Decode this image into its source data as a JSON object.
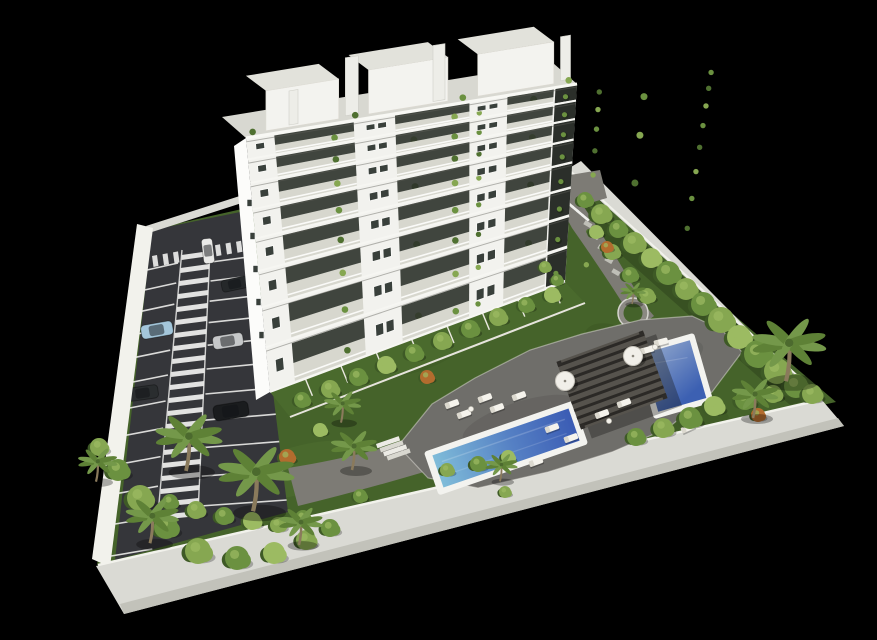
{
  "meta": {
    "scene_type": "3D architectural rendering, aerial oblique view",
    "description": "White multi-storey apartment block with plant-filled balconies on a walled plot with landscaped garden, two blue swimming pools, wooden pergola, sun loungers, palm trees and a marked parking lot with cars, on a black background",
    "width": 877,
    "height": 640
  },
  "palette": {
    "background": "#000000",
    "lawn": "#45632a",
    "lawnDark": "#3a5522",
    "lawnLight": "#527231",
    "asphalt": "#35363a",
    "asphaltDark": "#2c2d30",
    "deck": "#6f6e6a",
    "deckDark": "#5e5d59",
    "wall": "#dadad4",
    "wallLit": "#f2f2ec",
    "wallShade": "#c2c2ba",
    "building": "#f2f2ee",
    "buildingBright": "#fcfcfa",
    "roofGravel": "#d8d8d1",
    "balconyFloor": "#d7d7ce",
    "balconyDark": "rgba(44,50,42,0.9)",
    "windowDark": "#39403b",
    "slabWhite": "#f6f6f2",
    "lineWhite": "#ececea",
    "path": "#7d7b75",
    "planterGray": "#8b8982",
    "pergola": "#56534d",
    "pergolaSlat": "#2b2926",
    "poolRim": "#f3f3ef",
    "waterLight": "#7fbcd9",
    "waterMid": "#5580c4",
    "waterDeep": "#3b5cb4",
    "waterSmallLight": "#8fa6cc",
    "waterSmallDeep": "#3c60b2",
    "greens": [
      "#4f7030",
      "#6b9140",
      "#86a751",
      "#9cbb62",
      "#b26c2e",
      "#3e5a26"
    ],
    "trunk": "#8a7a5c",
    "lounger": "#f5f3ec",
    "loungerShade": "#dcd9cf"
  },
  "building": {
    "name": "white-apartment-block",
    "floors": 8,
    "balcony_bays_per_floor": 3,
    "penthouses": 3,
    "ground_floor_gardens": 8
  },
  "site": {
    "pools": 2,
    "pergolas": 1,
    "perimeter_wall": true,
    "parking_rows": 2,
    "zebra_walkway": true
  },
  "cars": [
    {
      "x": 208,
      "y": 251,
      "rot": 83,
      "s": 0.78,
      "color": "#e9e9e7",
      "kind": "white-van"
    },
    {
      "x": 235,
      "y": 284,
      "rot": -12,
      "s": 0.85,
      "color": "#25282a",
      "kind": "dark-car"
    },
    {
      "x": 157,
      "y": 330,
      "rot": -10,
      "s": 1.0,
      "color": "#a3c6da",
      "kind": "light-blue-car"
    },
    {
      "x": 228,
      "y": 341,
      "rot": -9,
      "s": 0.95,
      "color": "#c6c8c9",
      "kind": "silver-car"
    },
    {
      "x": 143,
      "y": 393,
      "rot": -8,
      "s": 0.95,
      "color": "#2a2d2f",
      "kind": "dark-car"
    },
    {
      "x": 231,
      "y": 411,
      "rot": -9,
      "s": 1.1,
      "color": "#1a1c1e",
      "kind": "black-car"
    },
    {
      "x": 574,
      "y": 198,
      "rot": 14,
      "s": 0.8,
      "color": "#eaeae8",
      "kind": "white-car"
    }
  ],
  "palms": [
    [
      186,
      468,
      1.45
    ],
    [
      253,
      508,
      1.65
    ],
    [
      150,
      541,
      1.15
    ],
    [
      299,
      543,
      0.95
    ],
    [
      96,
      480,
      0.85
    ],
    [
      341,
      421,
      0.8
    ],
    [
      352,
      468,
      1.0
    ],
    [
      500,
      480,
      0.7
    ],
    [
      632,
      303,
      0.55
    ],
    [
      786,
      378,
      1.6
    ],
    [
      753,
      416,
      1.0
    ]
  ],
  "bushes": [
    [
      585,
      200,
      8,
      1
    ],
    [
      601,
      214,
      10,
      2
    ],
    [
      618,
      229,
      9,
      1
    ],
    [
      634,
      243,
      11,
      2
    ],
    [
      651,
      258,
      10,
      3
    ],
    [
      668,
      273,
      12,
      1
    ],
    [
      686,
      289,
      11,
      2
    ],
    [
      703,
      304,
      12,
      1
    ],
    [
      721,
      320,
      13,
      2
    ],
    [
      739,
      337,
      12,
      3
    ],
    [
      758,
      354,
      14,
      1
    ],
    [
      777,
      371,
      13,
      2
    ],
    [
      796,
      386,
      12,
      1
    ],
    [
      812,
      394,
      10,
      2
    ],
    [
      596,
      232,
      7,
      3
    ],
    [
      612,
      252,
      8,
      2
    ],
    [
      630,
      275,
      8,
      1
    ],
    [
      647,
      296,
      8,
      2
    ],
    [
      607,
      247,
      6,
      4
    ],
    [
      545,
      267,
      6,
      2
    ],
    [
      557,
      280,
      6,
      1
    ],
    [
      302,
      400,
      8,
      1
    ],
    [
      330,
      389,
      9,
      2
    ],
    [
      358,
      377,
      9,
      1
    ],
    [
      386,
      365,
      9,
      3
    ],
    [
      414,
      353,
      9,
      1
    ],
    [
      427,
      377,
      7,
      4
    ],
    [
      442,
      341,
      9,
      2
    ],
    [
      470,
      329,
      9,
      1
    ],
    [
      498,
      317,
      9,
      2
    ],
    [
      526,
      305,
      8,
      1
    ],
    [
      552,
      295,
      8,
      3
    ],
    [
      447,
      470,
      7,
      2
    ],
    [
      478,
      464,
      8,
      1
    ],
    [
      508,
      457,
      7,
      3
    ],
    [
      636,
      437,
      9,
      1
    ],
    [
      663,
      428,
      10,
      2
    ],
    [
      690,
      418,
      11,
      1
    ],
    [
      714,
      406,
      10,
      3
    ],
    [
      287,
      457,
      8,
      4
    ],
    [
      170,
      502,
      8,
      1
    ],
    [
      196,
      510,
      9,
      2
    ],
    [
      224,
      516,
      9,
      1
    ],
    [
      252,
      521,
      9,
      3
    ],
    [
      278,
      525,
      8,
      2
    ],
    [
      303,
      518,
      8,
      1
    ],
    [
      118,
      470,
      11,
      1
    ],
    [
      140,
      498,
      13,
      2
    ],
    [
      166,
      527,
      12,
      1
    ],
    [
      198,
      551,
      13,
      2
    ],
    [
      237,
      558,
      12,
      1
    ],
    [
      274,
      553,
      11,
      3
    ],
    [
      99,
      447,
      9,
      2
    ],
    [
      306,
      540,
      10,
      2
    ],
    [
      330,
      528,
      9,
      1
    ],
    [
      745,
      400,
      10,
      1
    ],
    [
      773,
      394,
      9,
      2
    ],
    [
      758,
      415,
      7,
      4
    ],
    [
      320,
      430,
      7,
      3
    ],
    [
      505,
      492,
      6,
      2
    ],
    [
      360,
      496,
      7,
      1
    ]
  ],
  "loungers": [
    [
      452,
      404,
      -20
    ],
    [
      464,
      414,
      -20
    ],
    [
      485,
      398,
      -20
    ],
    [
      497,
      408,
      -20
    ],
    [
      519,
      396,
      -20
    ],
    [
      552,
      428,
      -20
    ],
    [
      571,
      438,
      -20
    ],
    [
      602,
      414,
      -20
    ],
    [
      624,
      403,
      -20
    ],
    [
      647,
      350,
      -15
    ],
    [
      661,
      342,
      -15
    ],
    [
      688,
      428,
      -25
    ],
    [
      536,
      462,
      -20
    ]
  ],
  "umbrellas": [
    [
      565,
      381
    ],
    [
      633,
      356
    ]
  ],
  "tables": [
    [
      471,
      409
    ],
    [
      609,
      421
    ],
    [
      655,
      347
    ]
  ]
}
